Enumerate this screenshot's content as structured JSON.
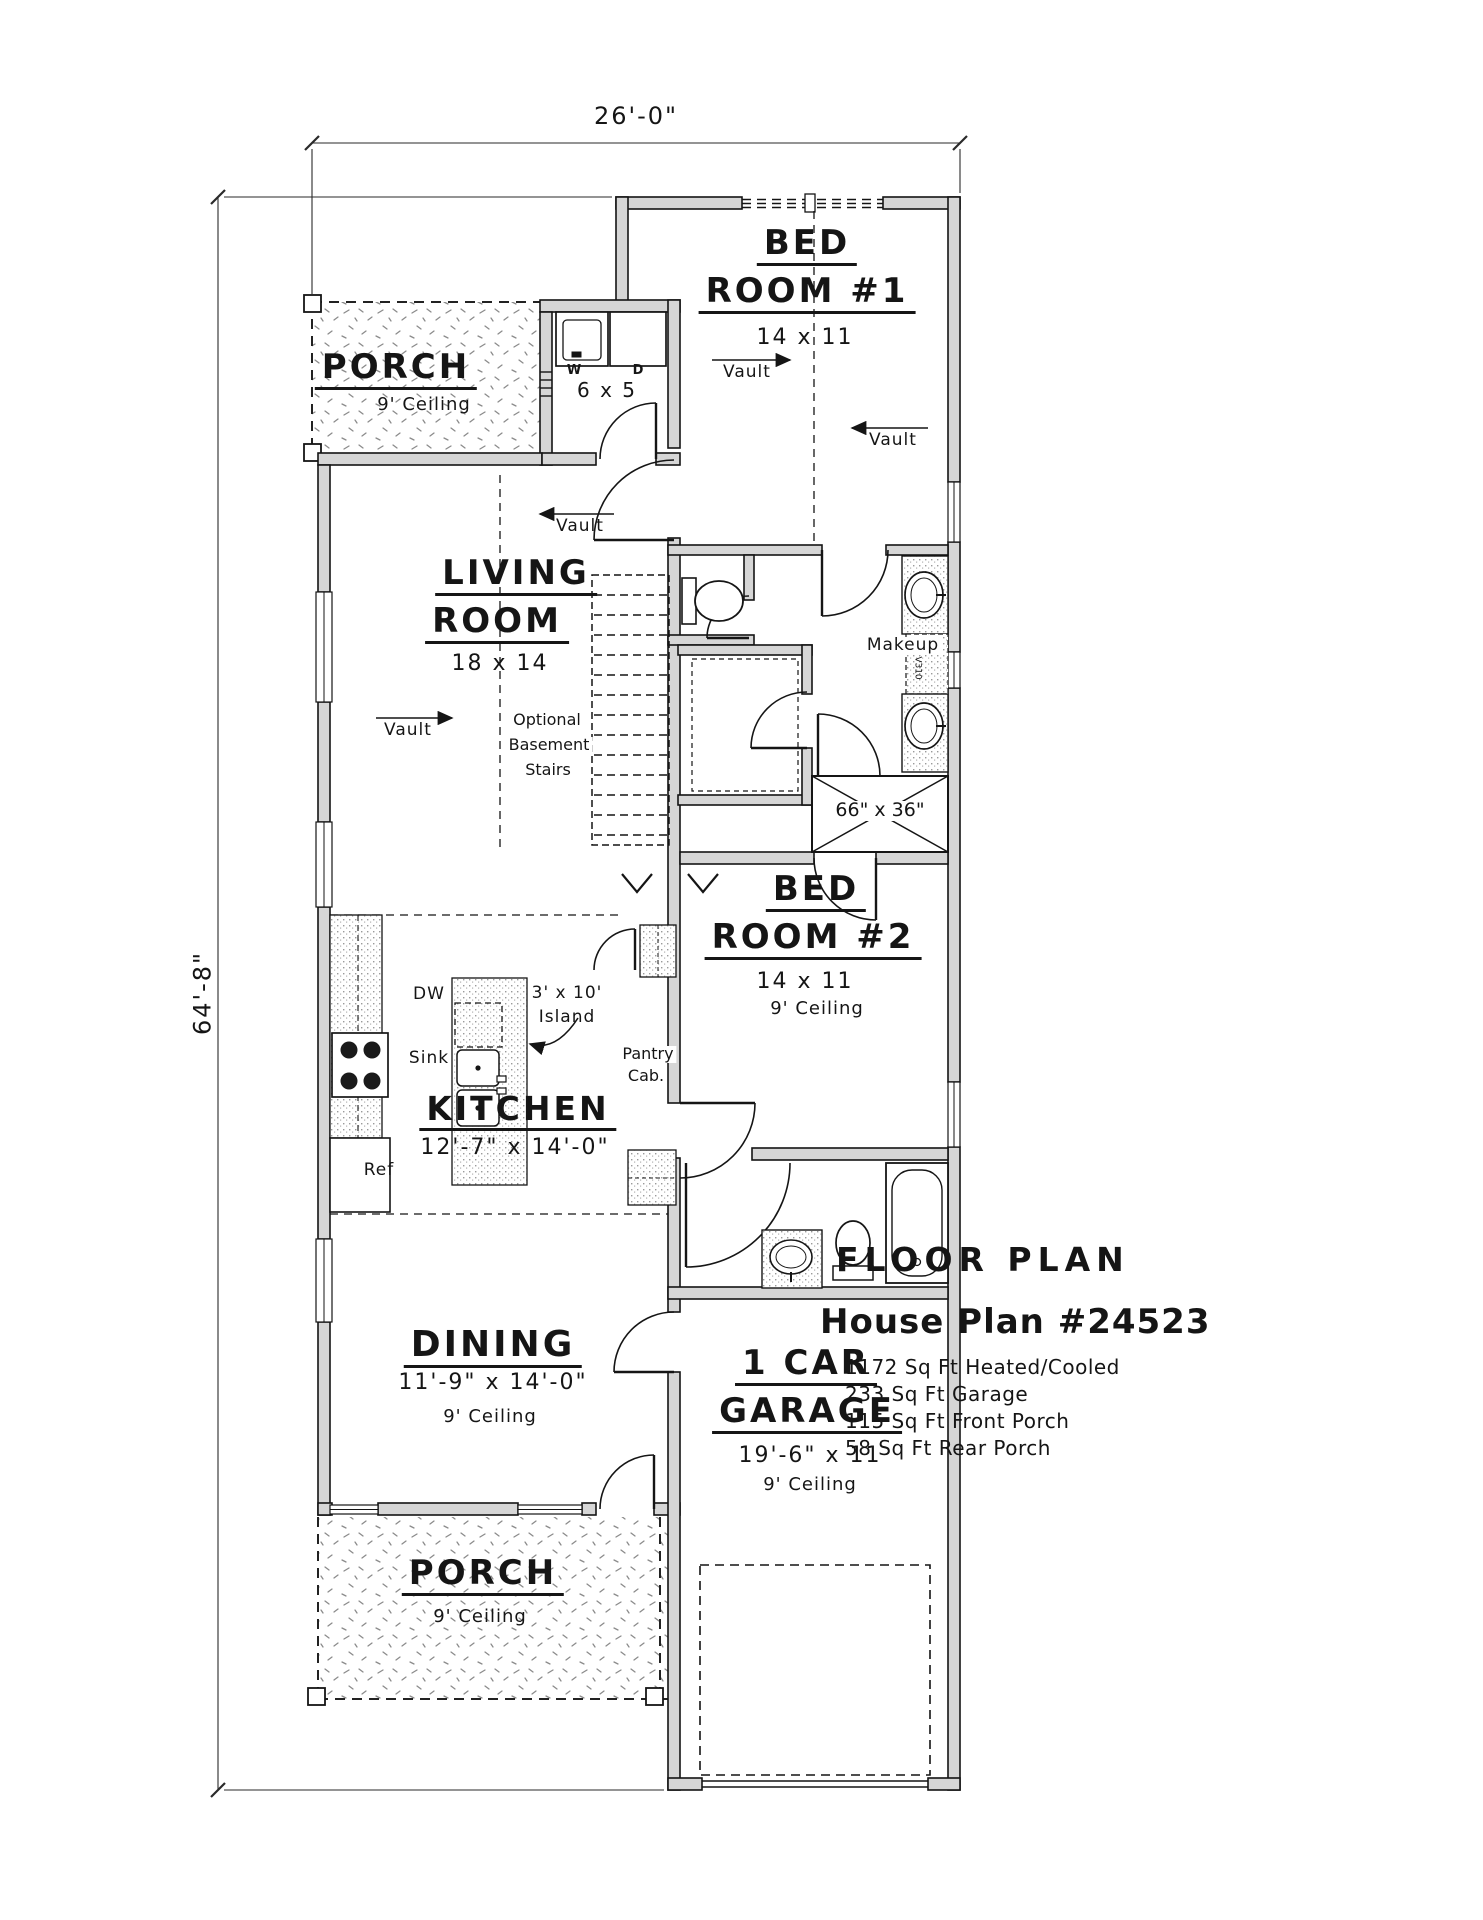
{
  "dims": {
    "top": "26'-0\"",
    "left": "64'-8\""
  },
  "annotations": {
    "vault": "Vault"
  },
  "rooms": {
    "porch_front": {
      "name": "PORCH",
      "ceil": "9' Ceiling"
    },
    "laundry": {
      "size": "6 x 5",
      "washer": "W",
      "dryer": "D"
    },
    "bed1": {
      "n1": "BED",
      "n2": "ROOM #1",
      "size": "14 x 11"
    },
    "living": {
      "n1": "LIVING",
      "n2": "ROOM",
      "size": "18 x 14"
    },
    "stairs": {
      "l1": "Optional",
      "l2": "Basement",
      "l3": "Stairs"
    },
    "bath": {
      "makeup": "Makeup",
      "cab": "V310",
      "shower": "66\" x 36\""
    },
    "bed2": {
      "n1": "BED",
      "n2": "ROOM #2",
      "size": "14 x 11",
      "ceil": "9' Ceiling"
    },
    "kitchen": {
      "name": "KITCHEN",
      "size": "12'-7\" x 14'-0\"",
      "dw": "DW",
      "sink": "Sink",
      "isl1": "3' x 10'",
      "isl2": "Island",
      "p1": "Pantry",
      "p2": "Cab.",
      "ref": "Ref"
    },
    "dining": {
      "name": "DINING",
      "size": "11'-9\" x 14'-0\"",
      "ceil": "9' Ceiling"
    },
    "garage": {
      "n1": "1 CAR",
      "n2": "GARAGE",
      "size": "19'-6\" x 11",
      "ceil": "9' Ceiling"
    },
    "porch_rear": {
      "name": "PORCH",
      "ceil": "9' Ceiling"
    }
  },
  "title": {
    "heading": "FLOOR PLAN",
    "plan": "House Plan #24523",
    "stats": [
      "1172 Sq Ft Heated/Cooled",
      "233 Sq Ft Garage",
      "115 Sq Ft Front Porch",
      "58 Sq Ft Rear Porch"
    ]
  },
  "colors": {
    "ink": "#151515",
    "wall_fill": "#d6d6d6",
    "paper": "#ffffff"
  }
}
